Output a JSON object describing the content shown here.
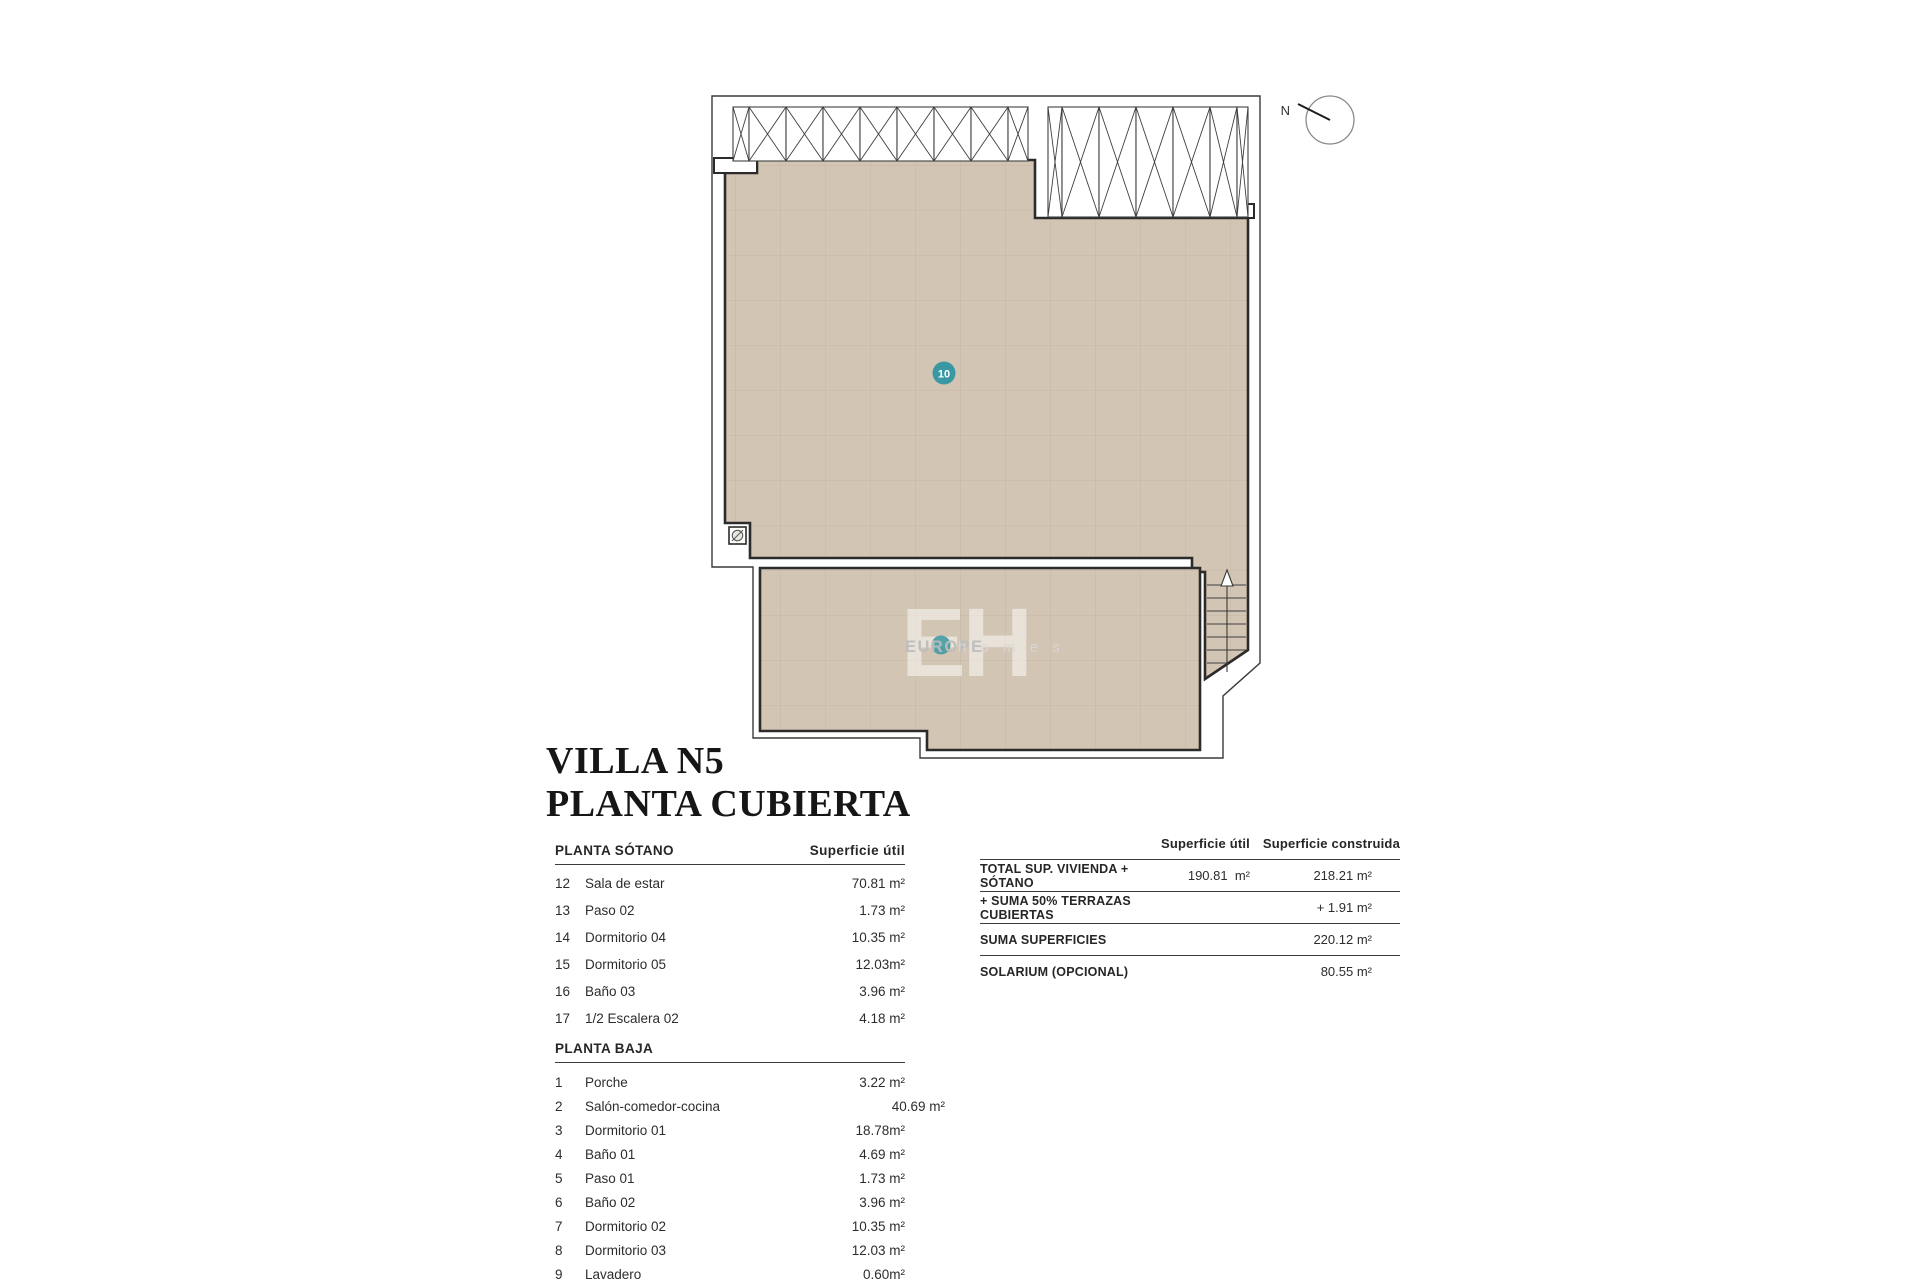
{
  "title": {
    "line1": "VILLA N5",
    "line2": "PLANTA CUBIERTA"
  },
  "plan": {
    "north_label": "N",
    "room_badge": "10",
    "watermark": {
      "eh": "EH",
      "europe": "EUROPE",
      "homes": "h o m e s"
    },
    "colors": {
      "terrace_fill": "#d3c5b4",
      "grid_line": "#c5b6a3",
      "wall_line": "#2b2b2b",
      "badge_teal": "#3a98a2"
    },
    "icons": [
      "north-indicator-icon",
      "drain-icon",
      "stairs-up-arrow-icon",
      "pergola-hatch-icon"
    ]
  },
  "tables": {
    "sotano": {
      "header": "PLANTA SÓTANO",
      "col_header": "Superficie útil",
      "rows": [
        {
          "num": "12",
          "name": "Sala de estar",
          "value": "70.81 m²"
        },
        {
          "num": "13",
          "name": "Paso 02",
          "value": "1.73 m²"
        },
        {
          "num": "14",
          "name": "Dormitorio 04",
          "value": "10.35 m²"
        },
        {
          "num": "15",
          "name": "Dormitorio 05",
          "value": "12.03m²"
        },
        {
          "num": "16",
          "name": "Baño 03",
          "value": "3.96 m²"
        },
        {
          "num": "17",
          "name": "1/2 Escalera 02",
          "value": "4.18 m²"
        }
      ]
    },
    "baja": {
      "header": "PLANTA BAJA",
      "rows": [
        {
          "num": "1",
          "name": "Porche",
          "value": "3.22 m²"
        },
        {
          "num": "2",
          "name": "Salón-comedor-cocina",
          "value": "40.69 m²"
        },
        {
          "num": "3",
          "name": "Dormitorio 01",
          "value": "18.78m²"
        },
        {
          "num": "4",
          "name": "Baño 01",
          "value": "4.69 m²"
        },
        {
          "num": "5",
          "name": "Paso 01",
          "value": "1.73 m²"
        },
        {
          "num": "6",
          "name": "Baño 02",
          "value": "3.96 m²"
        },
        {
          "num": "7",
          "name": "Dormitorio 02",
          "value": "10.35 m²"
        },
        {
          "num": "8",
          "name": "Dormitorio 03",
          "value": "12.03 m²"
        },
        {
          "num": "9",
          "name": "Lavadero",
          "value": "0.60m²"
        }
      ]
    },
    "summary": {
      "col1_header": "Superficie útil",
      "col2_header": "Superficie construida",
      "rows": [
        {
          "label": "TOTAL SUP. VIVIENDA + SÓTANO",
          "util": "190.81  m²",
          "construida": "218.21 m²"
        },
        {
          "label": "+ SUMA 50% TERRAZAS CUBIERTAS",
          "util": "",
          "construida": "+ 1.91 m²"
        },
        {
          "label": "SUMA SUPERFICIES",
          "util": "",
          "construida": "220.12 m²"
        },
        {
          "label": "SOLARIUM (OPCIONAL)",
          "util": "",
          "construida": "80.55 m²"
        }
      ]
    }
  }
}
